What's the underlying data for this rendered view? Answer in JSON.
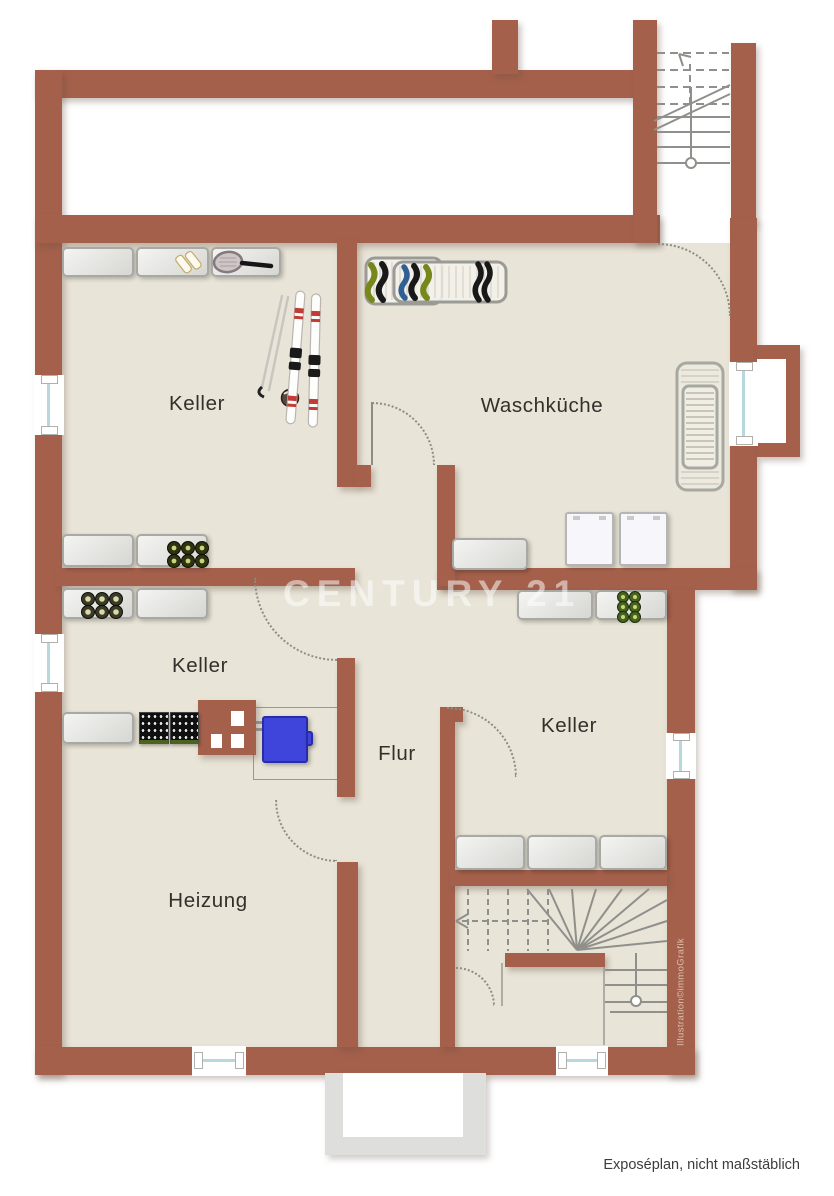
{
  "plan": {
    "watermark": "CENTURY 21",
    "credit": "Illustration©immoGrafik",
    "caption": "Exposéplan, nicht maßstäblich",
    "rooms": {
      "keller_top_left": {
        "label": "Keller"
      },
      "waschkueche": {
        "label": "Waschküche"
      },
      "keller_middle": {
        "label": "Keller"
      },
      "keller_right": {
        "label": "Keller"
      },
      "flur": {
        "label": "Flur"
      },
      "heizung": {
        "label": "Heizung"
      }
    },
    "colors": {
      "wall": "#a4604b",
      "floor": "#e8e4d7",
      "tank_blue": "#3f45da",
      "window_glazing": "#b7d9dd",
      "exterior_stair_gray": "#dededd",
      "watermark_white": "rgba(255,255,255,0.52)"
    },
    "furniture_icons": [
      "shelf",
      "ice-skates",
      "tennis-racket",
      "skis",
      "ski-poles",
      "drying-rack",
      "washing-machine",
      "wine-bottles",
      "beverage-crates",
      "chimney",
      "oil-tank",
      "radiator",
      "staircase",
      "window",
      "door-swing-arc"
    ]
  }
}
